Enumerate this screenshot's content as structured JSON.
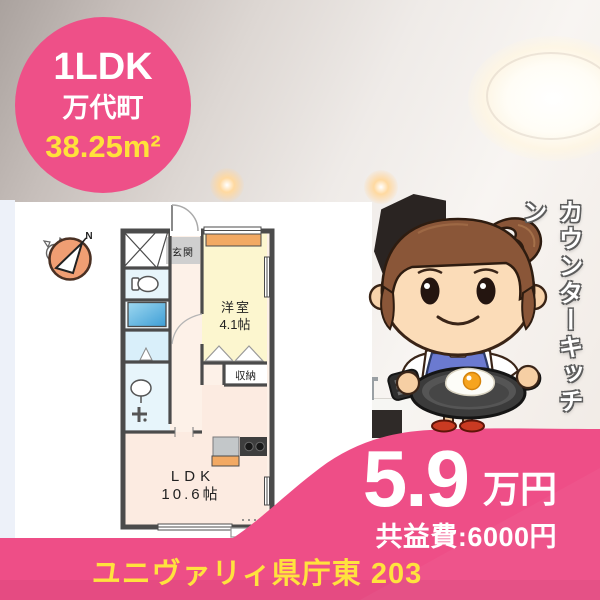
{
  "badge": {
    "layout": "1LDK",
    "town": "万代町",
    "area": "38.25m²"
  },
  "floor_plan": {
    "compass_north": "N",
    "entrance_label": "玄関",
    "western_room_name": "洋室",
    "western_room_size": "4.1帖",
    "closet_label": "収納",
    "ldk_name": "LDK",
    "ldk_size": "10.6帖"
  },
  "photo": {
    "vertical_caption": "カウンターキッチン"
  },
  "price": {
    "rent": "5.9",
    "unit": "万円",
    "common_fee": "共益費:6000円"
  },
  "footer": {
    "property_name": "ユニヴァリィ県庁東 203"
  },
  "colors": {
    "accent_pink": "#ee4e87",
    "highlight_yellow": "#ffe13a",
    "plan_wall": "#4b4b4b",
    "apron_blue": "#6b7ad0"
  }
}
